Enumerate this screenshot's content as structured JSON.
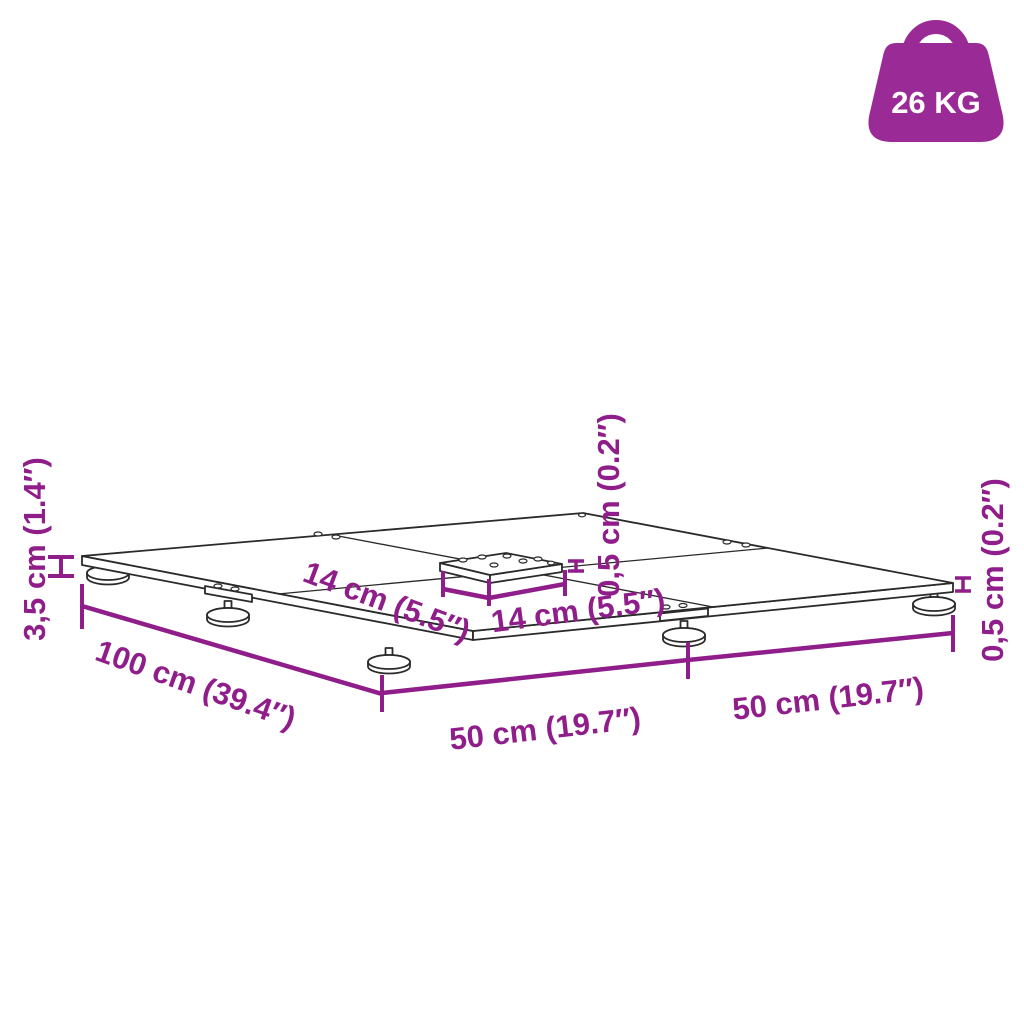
{
  "colors": {
    "dimension_purple": "#8F1D8A",
    "badge_purple": "#9A2B96",
    "line_dark": "#2A2A2A",
    "background": "#FFFFFF"
  },
  "weight_badge": {
    "icon": "weight-kettlebell-icon",
    "label": "26 KG"
  },
  "diagram": {
    "subject": "parasol-base-plate-dimension-drawing",
    "labels": {
      "total_height": "3,5 cm (1.4″)",
      "side_length": "100 cm (39.4″)",
      "front_left_width": "50 cm (19.7″)",
      "front_right_width": "50 cm (19.7″)",
      "center_plate_depth": "14 cm (5.5″)",
      "center_plate_width": "14 cm (5.5″)",
      "plate_thickness_center": "0,5 cm (0.2″)",
      "plate_thickness_corner": "0,5 cm (0.2″)"
    }
  }
}
